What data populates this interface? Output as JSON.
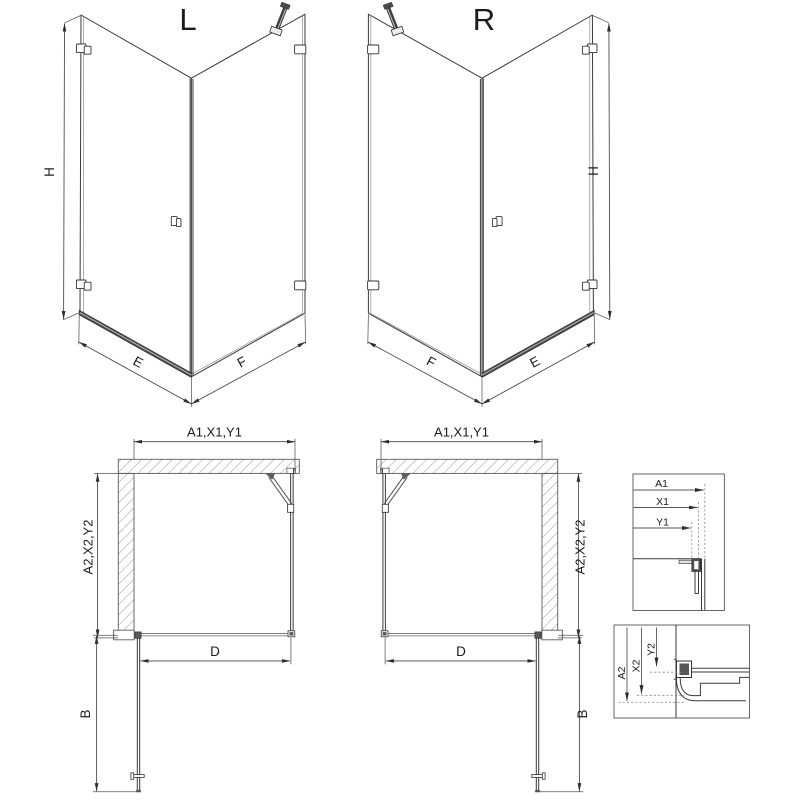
{
  "title_labels": {
    "left_view": "L",
    "right_view": "R"
  },
  "iso_dimensions": {
    "height": "H",
    "door_side": "E",
    "fixed_side": "F"
  },
  "plan_dimensions": {
    "width_series": "A1,X1,Y1",
    "depth_series": "A2,X2,Y2",
    "entry_width": "D",
    "door_width": "B"
  },
  "detail_width": {
    "labels": [
      "A1",
      "X1",
      "Y1"
    ]
  },
  "detail_depth": {
    "labels": [
      "A2",
      "X2",
      "Y2"
    ]
  },
  "colors": {
    "line": "#3a3a3a",
    "dim_line": "#444444",
    "dark_fill": "#4f4f4f",
    "hatch": "#8c8c8c",
    "background": "#ffffff"
  }
}
